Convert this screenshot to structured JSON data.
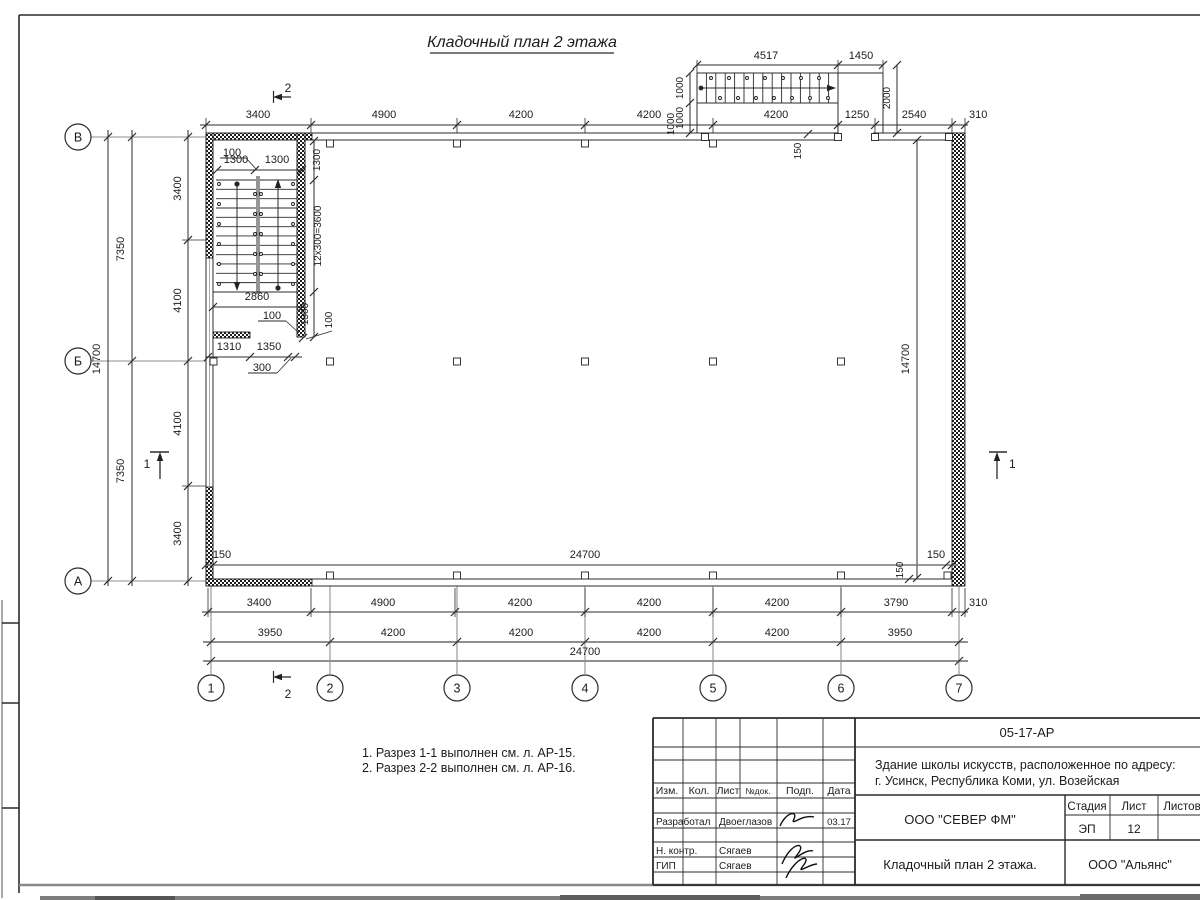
{
  "sheet": {
    "title": "Кладочный план 2 этажа",
    "notes": [
      "1. Разрез 1-1 выполнен см. л. АР-15.",
      "2. Разрез 2-2 выполнен см. л. АР-16."
    ]
  },
  "axes": {
    "rows": [
      "В",
      "Б",
      "А"
    ],
    "cols": [
      "1",
      "2",
      "3",
      "4",
      "5",
      "6",
      "7"
    ],
    "sections": {
      "one": "1",
      "two": "2"
    }
  },
  "dims": {
    "top_chain": [
      "3400",
      "4900",
      "4200",
      "4200",
      "4200",
      "1250",
      "2540",
      "310"
    ],
    "chain1": [
      "3400",
      "4900",
      "4200",
      "4200",
      "4200",
      "3790",
      "310"
    ],
    "chain2": [
      "3950",
      "4200",
      "4200",
      "4200",
      "4200",
      "3950"
    ],
    "chain3": "24700",
    "left_inner": [
      "3400",
      "4100",
      "4100",
      "3400"
    ],
    "left_mid": [
      "7350",
      "7350"
    ],
    "left_outer": "14700",
    "right_inner": "14700",
    "inner_bottom": {
      "l150": "150",
      "c24700": "24700",
      "r150": "150",
      "v150": "150"
    },
    "porch": {
      "w1": "4517",
      "w2": "1450",
      "l1": "1000",
      "l2": "1000",
      "l3": "1000",
      "r": "2000",
      "t150": "150"
    },
    "stairwell": {
      "top100": "100",
      "top1300a": "1300",
      "top1300b": "1300",
      "v1300": "1300",
      "v3600": "12x300=3600",
      "w2860": "2860",
      "mid100": "100",
      "v1500": "1500",
      "v100": "100",
      "b1310": "1310",
      "b1350": "1350",
      "b300": "300"
    }
  },
  "titleblock": {
    "code": "05-17-АР",
    "project_line1": "Здание школы искусств, расположенное по адресу:",
    "project_line2": "г. Усинск, Республика Коми, ул. Возейская",
    "org": "ООО \"СЕВЕР ФМ\"",
    "drawing_title": "Кладочный план 2 этажа.",
    "org2": "ООО \"Альянс\"",
    "headers": {
      "izm": "Изм.",
      "kol": "Кол.",
      "list": "Лист",
      "ndok": "№док.",
      "podp": "Подп.",
      "data": "Дата"
    },
    "stage_label": "Стадия",
    "sheet_label": "Лист",
    "sheets_label": "Листов",
    "stage": "ЭП",
    "sheet_no": "12",
    "rows": [
      {
        "role": "Разработал",
        "name": "Двоеглазов",
        "date": "03.17"
      },
      {
        "role": "Н. контр.",
        "name": "Сягаев",
        "date": ""
      },
      {
        "role": "ГИП",
        "name": "Сягаев",
        "date": ""
      }
    ]
  }
}
